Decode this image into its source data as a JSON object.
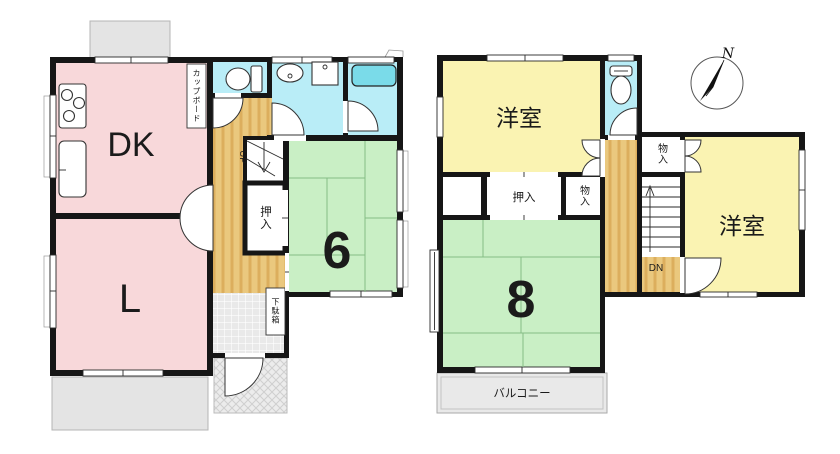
{
  "colors": {
    "wall": "#161616",
    "room_pink": "#f8d8da",
    "tatami_green": "#c9efc5",
    "western_yellow": "#faf3b2",
    "wet_cyan": "#b9edf7",
    "bathtub_cyan": "#7adbe9",
    "porch_gray": "#e4e4e4"
  },
  "floor1": {
    "dining_kitchen": "DK",
    "living": "L",
    "tatami6": "6",
    "closet": "押入",
    "cupboard": "カップボード",
    "shoe_cabinet": "下駄箱",
    "stairs_up": "UP"
  },
  "floor2": {
    "western1": "洋室",
    "western2": "洋室",
    "tatami8": "8",
    "closet": "押入",
    "storage_a": "物入",
    "storage_b": "物入",
    "stairs_down": "DN",
    "balcony": "バルコニー",
    "compass_north": "N"
  }
}
